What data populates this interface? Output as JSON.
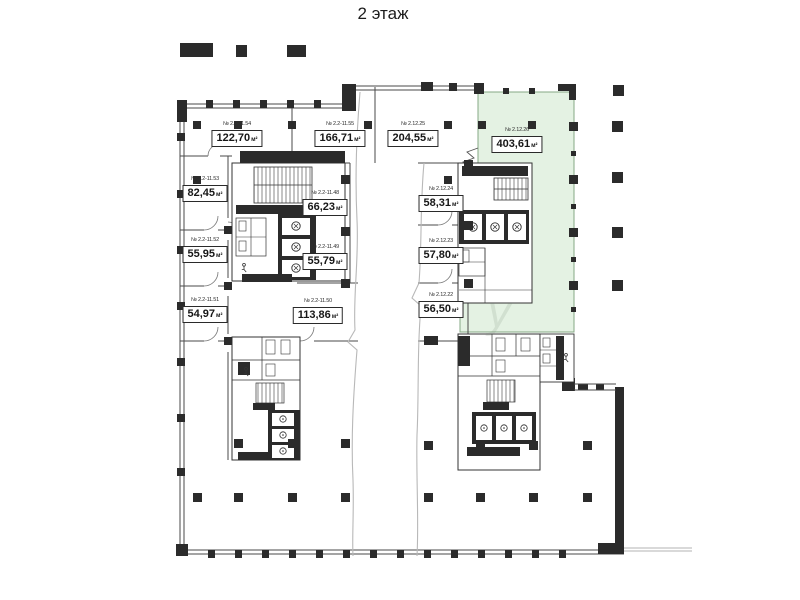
{
  "title": "2 этаж",
  "colors": {
    "highlight_fill": "#e4f2e3",
    "highlight_border": "#86a886",
    "wall_dark": "#2b2b2b",
    "wall_line": "#4a4a4a"
  },
  "highlighted_room": "№ 2.12.26",
  "rooms": [
    {
      "number": "№ 2.2-11.54",
      "area": "122,70",
      "unit": "м²"
    },
    {
      "number": "№ 2.2-11.55",
      "area": "166,71",
      "unit": "м²"
    },
    {
      "number": "№ 2.12.25",
      "area": "204,55",
      "unit": "м²"
    },
    {
      "number": "№ 2.12.26",
      "area": "403,61",
      "unit": "м²"
    },
    {
      "number": "№ 2.2-11.53",
      "area": "82,45",
      "unit": "м²"
    },
    {
      "number": "№ 2.2-11.48",
      "area": "66,23",
      "unit": "м²"
    },
    {
      "number": "№ 2.12.24",
      "area": "58,31",
      "unit": "м²"
    },
    {
      "number": "№ 2.2-11.52",
      "area": "55,95",
      "unit": "м²"
    },
    {
      "number": "№ 2.2-11.49",
      "area": "55,79",
      "unit": "м²"
    },
    {
      "number": "№ 2.12.23",
      "area": "57,80",
      "unit": "м²"
    },
    {
      "number": "№ 2.2-11.51",
      "area": "54,97",
      "unit": "м²"
    },
    {
      "number": "№ 2.2-11.50",
      "area": "113,86",
      "unit": "м²"
    },
    {
      "number": "№ 2.12.22",
      "area": "56,50",
      "unit": "м²"
    }
  ]
}
